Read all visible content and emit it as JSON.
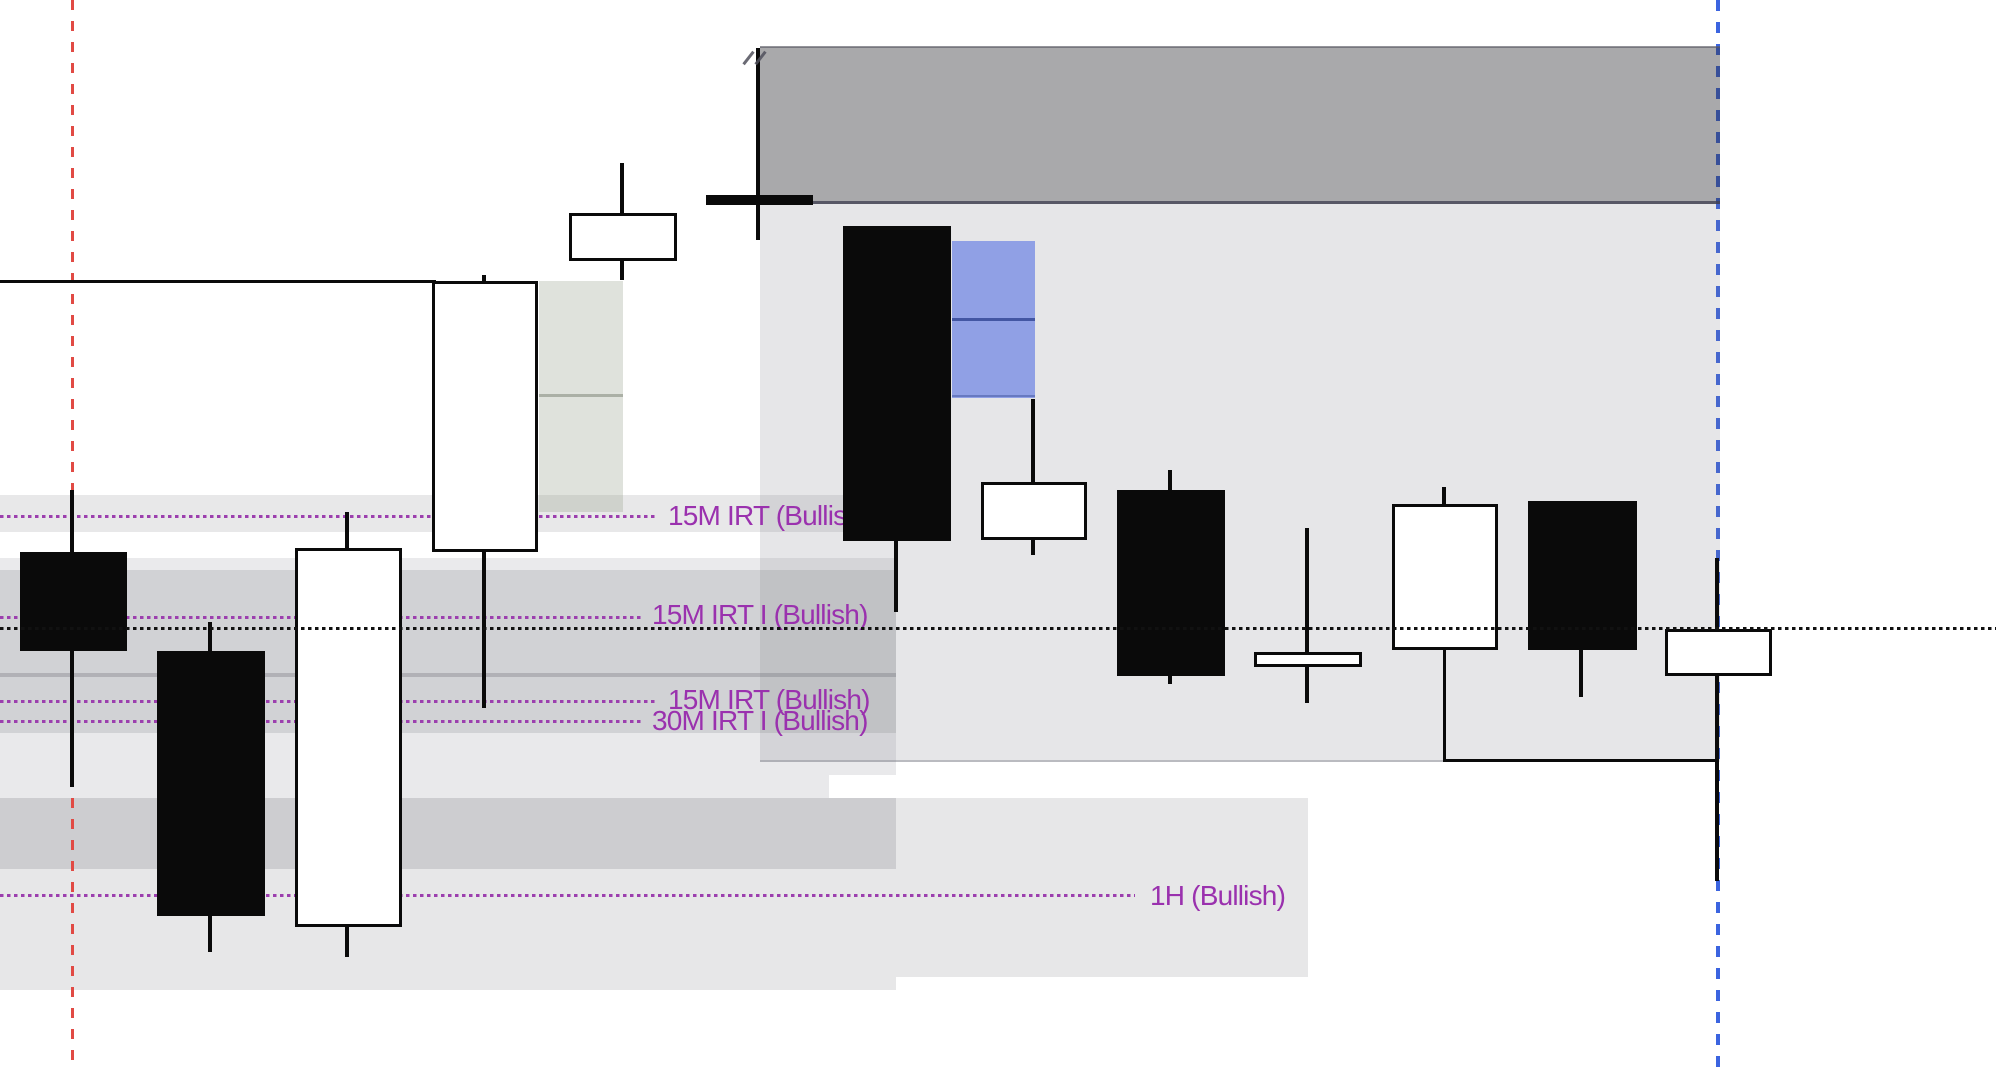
{
  "canvas": {
    "width": 1996,
    "height": 1068,
    "background": "#FFFFFF"
  },
  "colors": {
    "label_purple": "#9A31AE",
    "purple_dot": "#9C3FAE",
    "session_red": "#E14A44",
    "session_blue": "#3B64E0",
    "candle_black": "#0A0A0A",
    "candle_white": "#FFFFFF",
    "supply_box_dark": "rgba(50,50,55,0.42)",
    "supply_box_light": "rgba(120,122,132,0.185)",
    "band_gray": "rgba(125,126,134,0.17)",
    "fvg_green_gray": "rgba(148,158,140,0.30)",
    "fvg_blue": "rgba(70,100,228,0.54)",
    "black_dotted": "#111111"
  },
  "chart_data": {
    "type": "candlestick",
    "title": "",
    "axes_visible": false,
    "units_note": "No axis tick labels are visible in the screenshot; all geometry is captured in screen pixels (y increases downward, so smaller y = higher price).",
    "candles": [
      {
        "idx": 1,
        "direction": "bearish",
        "x": 20,
        "w": 107,
        "cx": 72,
        "body_top": 552,
        "body_bottom": 651,
        "high_y": 490,
        "low_y": 787
      },
      {
        "idx": 2,
        "direction": "bearish",
        "x": 157,
        "w": 108,
        "cx": 210,
        "body_top": 651,
        "body_bottom": 916,
        "high_y": 622,
        "low_y": 952
      },
      {
        "idx": 3,
        "direction": "bullish",
        "x": 295,
        "w": 107,
        "cx": 347,
        "body_top": 548,
        "body_bottom": 927,
        "high_y": 512,
        "low_y": 957
      },
      {
        "idx": 4,
        "direction": "bullish",
        "x": 432,
        "w": 106,
        "cx": 484,
        "body_top": 281,
        "body_bottom": 552,
        "high_y": 275,
        "low_y": 708
      },
      {
        "idx": 5,
        "direction": "bullish",
        "x": 569,
        "w": 108,
        "cx": 622,
        "body_top": 213,
        "body_bottom": 261,
        "high_y": 163,
        "low_y": 280
      },
      {
        "idx": 6,
        "direction": "bearish",
        "x": 706,
        "w": 107,
        "cx": 758,
        "body_top": 195,
        "body_bottom": 205,
        "high_y": 48,
        "low_y": 240
      },
      {
        "idx": 7,
        "direction": "bearish",
        "x": 843,
        "w": 108,
        "cx": 896,
        "body_top": 226,
        "body_bottom": 541,
        "high_y": 226,
        "low_y": 612
      },
      {
        "idx": 8,
        "direction": "bullish",
        "x": 981,
        "w": 106,
        "cx": 1033,
        "body_top": 482,
        "body_bottom": 540,
        "high_y": 399,
        "low_y": 555
      },
      {
        "idx": 9,
        "direction": "bearish",
        "x": 1117,
        "w": 108,
        "cx": 1170,
        "body_top": 490,
        "body_bottom": 676,
        "high_y": 470,
        "low_y": 684
      },
      {
        "idx": 10,
        "direction": "bullish",
        "x": 1254,
        "w": 108,
        "cx": 1307,
        "body_top": 652,
        "body_bottom": 667,
        "high_y": 528,
        "low_y": 703
      },
      {
        "idx": 11,
        "direction": "bullish",
        "x": 1392,
        "w": 106,
        "cx": 1444,
        "body_top": 504,
        "body_bottom": 650,
        "high_y": 487,
        "low_y": 650
      },
      {
        "idx": 12,
        "direction": "bearish",
        "x": 1528,
        "w": 109,
        "cx": 1581,
        "body_top": 501,
        "body_bottom": 650,
        "high_y": 501,
        "low_y": 697
      },
      {
        "idx": 13,
        "direction": "bullish",
        "x": 1665,
        "w": 107,
        "cx": 1717,
        "body_top": 629,
        "body_bottom": 676,
        "high_y": 558,
        "low_y": 881
      }
    ],
    "annotations": [
      {
        "label": "15M IRT (Bullish)",
        "line_y": 515,
        "dots_to": 656,
        "label_x": 668,
        "label_y": 517
      },
      {
        "label": "15M IRT I (Bullish)",
        "line_y": 616,
        "dots_to": 643,
        "label_x": 652,
        "label_y": 616
      },
      {
        "label": "15M IRT (Bullish)",
        "line_y": 700,
        "dots_to": 656,
        "label_x": 668,
        "label_y": 701
      },
      {
        "label": "30M IRT I (Bullish)",
        "line_y": 720,
        "dots_to": 643,
        "label_x": 652,
        "label_y": 722
      },
      {
        "label": "1H (Bullish)",
        "line_y": 894,
        "dots_to": 1135,
        "label_x": 1150,
        "label_y": 897
      }
    ],
    "zones": [
      {
        "name": "supply-box-dark",
        "x": 760,
        "y": 47,
        "w": 960,
        "h": 157,
        "fill": "rgba(50,50,55,0.42)"
      },
      {
        "name": "supply-box-dark-top-edge",
        "x": 760,
        "y": 46,
        "w": 960,
        "h": 2,
        "fill": "rgba(90,90,100,0.65)"
      },
      {
        "name": "supply-box-dark-bot-edge",
        "x": 760,
        "y": 201,
        "w": 960,
        "h": 3,
        "fill": "rgba(66,66,84,0.8)"
      },
      {
        "name": "supply-box-light",
        "x": 760,
        "y": 204,
        "w": 960,
        "h": 558,
        "fill": "rgba(120,122,132,0.185)"
      },
      {
        "name": "supply-box-light-bot-edge",
        "x": 760,
        "y": 760,
        "w": 685,
        "h": 2,
        "fill": "rgba(120,122,132,0.4)"
      },
      {
        "name": "band-15m-irt",
        "x": 0,
        "y": 495,
        "w": 896,
        "h": 37,
        "fill": "rgba(125,126,134,0.18)"
      },
      {
        "name": "band-upper-a",
        "x": 0,
        "y": 558,
        "w": 896,
        "h": 175,
        "fill": "rgba(125,126,134,0.16)"
      },
      {
        "name": "band-upper-b",
        "x": 0,
        "y": 570,
        "w": 896,
        "h": 163,
        "fill": "rgba(125,126,134,0.22)"
      },
      {
        "name": "band-upper-divider",
        "x": 0,
        "y": 673,
        "w": 896,
        "h": 4,
        "fill": "rgba(95,95,105,0.28)"
      },
      {
        "name": "band-mid-a",
        "x": 0,
        "y": 733,
        "w": 896,
        "h": 42,
        "fill": "rgba(125,126,134,0.17)"
      },
      {
        "name": "band-mid-b",
        "x": 0,
        "y": 775,
        "w": 829,
        "h": 23,
        "fill": "rgba(125,126,134,0.17)"
      },
      {
        "name": "band-1h-zone",
        "x": 0,
        "y": 798,
        "w": 1308,
        "h": 179,
        "fill": "rgba(125,126,134,0.19)"
      },
      {
        "name": "band-1h-inner",
        "x": 0,
        "y": 798,
        "w": 896,
        "h": 71,
        "fill": "rgba(125,126,134,0.24)"
      },
      {
        "name": "band-1h-tail",
        "x": 0,
        "y": 977,
        "w": 896,
        "h": 13,
        "fill": "rgba(125,126,134,0.19)"
      },
      {
        "name": "fvg-green-gray",
        "x": 539,
        "y": 281,
        "w": 84,
        "h": 231,
        "fill": "rgba(148,158,140,0.30)"
      },
      {
        "name": "fvg-green-gray-divider",
        "x": 539,
        "y": 394,
        "w": 84,
        "h": 3,
        "fill": "rgba(108,115,100,0.45)"
      },
      {
        "name": "fvg-blue",
        "x": 952,
        "y": 241,
        "w": 83,
        "h": 157,
        "fill": "rgba(70,100,228,0.54)"
      },
      {
        "name": "fvg-blue-divider",
        "x": 952,
        "y": 318,
        "w": 83,
        "h": 3,
        "fill": "rgba(42,62,140,0.75)"
      },
      {
        "name": "fvg-blue-bot-edge",
        "x": 952,
        "y": 395,
        "w": 83,
        "h": 2,
        "fill": "rgba(42,62,140,0.4)"
      }
    ],
    "vlines": [
      {
        "name": "session-line-red",
        "x": 71,
        "w": 3,
        "y1": 0,
        "y2": 1068,
        "color": "#E14A44",
        "dash": 10,
        "gap": 11
      },
      {
        "name": "session-line-blue",
        "x": 1716,
        "w": 4,
        "y1": 0,
        "y2": 1068,
        "color": "#3B64E0",
        "dash": 11,
        "gap": 11
      }
    ],
    "hline_black": {
      "y": 627,
      "x1": 0,
      "x2": 1996,
      "h": 3,
      "dot": 3.4,
      "gap": 3.6,
      "color": "#111111"
    },
    "open_line": {
      "y": 280,
      "x1": 0,
      "x2": 436,
      "h": 3,
      "color": "#0A0A0A"
    },
    "path_line": {
      "vx": 1443,
      "vy1": 650,
      "vy2": 762,
      "hy": 759,
      "hx1": 1443,
      "hx2": 1719,
      "t": 3,
      "color": "#0A0A0A"
    },
    "marks": [
      {
        "x": 747,
        "y": 50
      },
      {
        "x": 759,
        "y": 50
      }
    ]
  }
}
